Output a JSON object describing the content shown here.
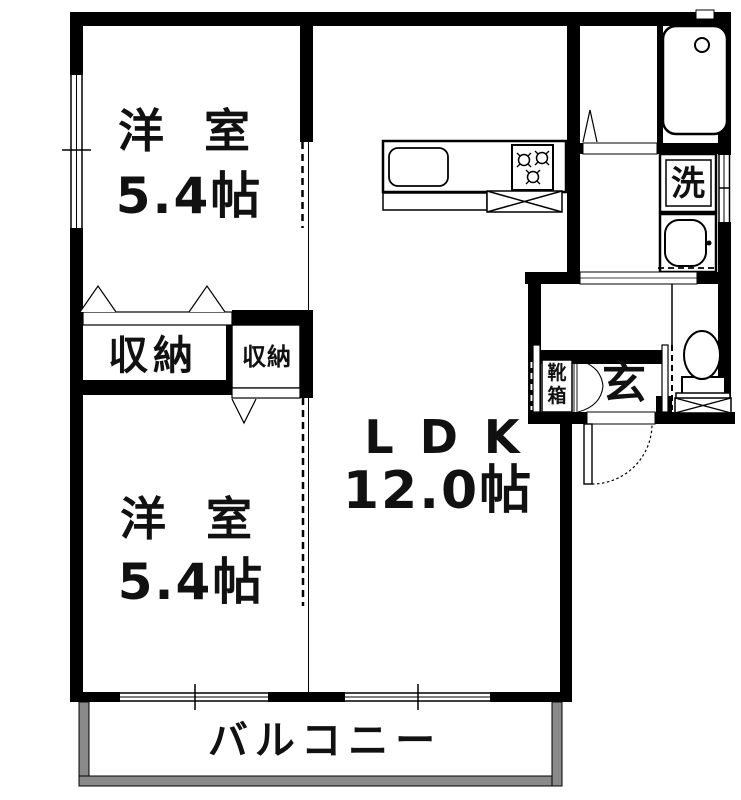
{
  "rooms": {
    "bedroom_top": {
      "name": "洋 室",
      "size": "5.4帖"
    },
    "bedroom_bottom": {
      "name": "洋 室",
      "size": "5.4帖"
    },
    "ldk": {
      "name": "LDK",
      "size": "12.0帖"
    },
    "closet_large": {
      "name": "収納"
    },
    "closet_small": {
      "name": "収納"
    },
    "entrance": {
      "name": "玄"
    },
    "shoe_cabinet": {
      "name": "靴箱"
    },
    "laundry": {
      "name": "洗"
    },
    "balcony": {
      "name": "バルコニー"
    }
  },
  "fixtures": [
    "bathtub",
    "toilet",
    "wash-basin",
    "kitchen-sink",
    "gas-stove",
    "refrigerator-space",
    "entry-door",
    "sliding-doors",
    "windows"
  ],
  "colors": {
    "wall": "#000000",
    "background": "#ffffff",
    "balcony_border": "#8a8a8a",
    "text": "#111111"
  }
}
